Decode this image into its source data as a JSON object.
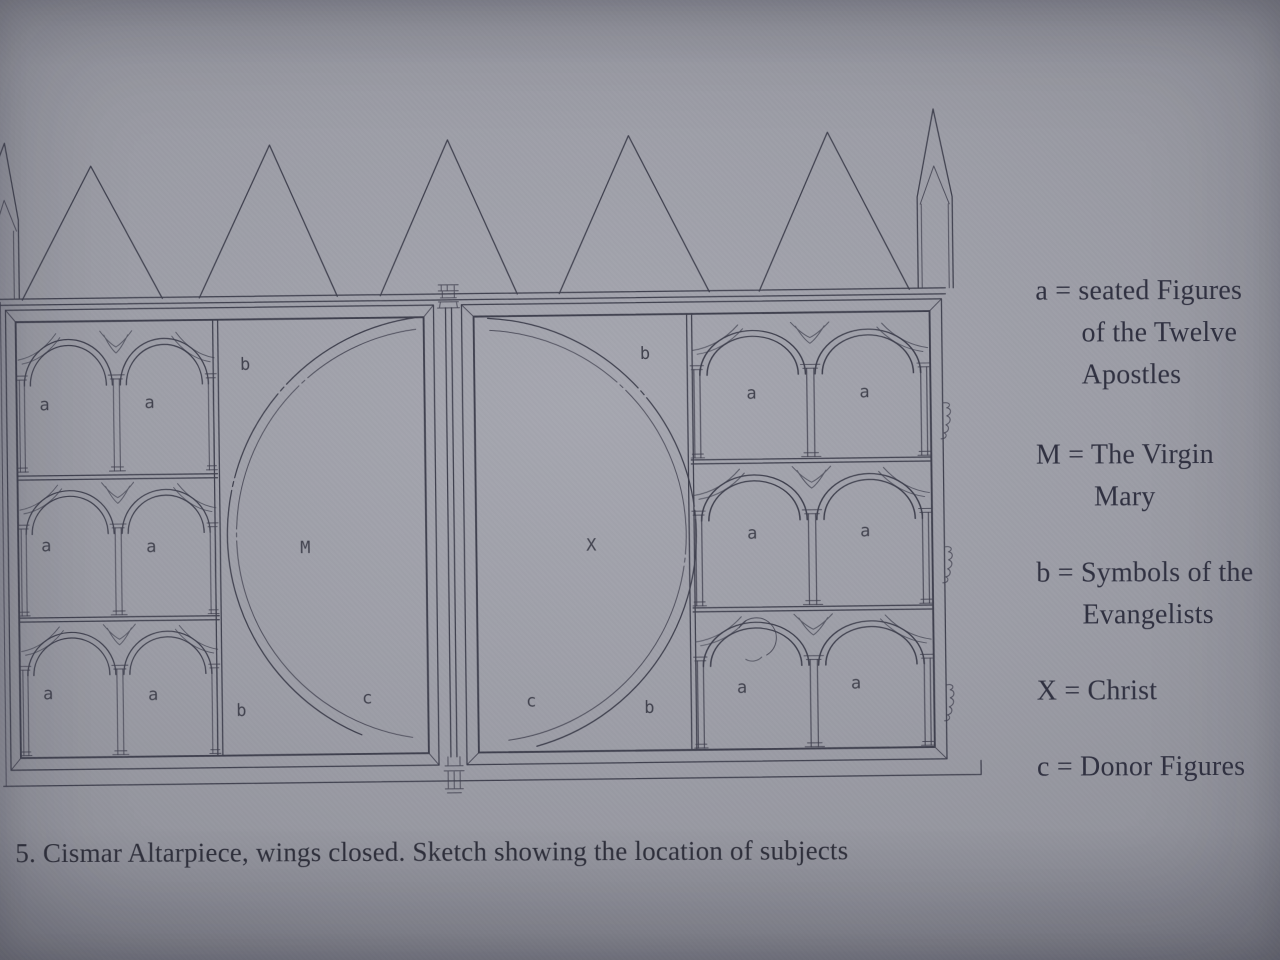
{
  "caption": "5. Cismar Altarpiece, wings closed. Sketch showing the location of subjects",
  "legend": {
    "entries": [
      {
        "symbol": "a",
        "meaning": "seated Figures of the Twelve Apostles",
        "lines": [
          "a = seated Figures",
          "of the Twelve",
          "Apostles"
        ]
      },
      {
        "symbol": "M",
        "meaning": "The Virgin Mary",
        "lines": [
          "M = The Virgin",
          "Mary"
        ]
      },
      {
        "symbol": "b",
        "meaning": "Symbols of the Evangelists",
        "lines": [
          "b = Symbols of the",
          "Evangelists"
        ]
      },
      {
        "symbol": "X",
        "meaning": "Christ",
        "lines": [
          "X = Christ"
        ]
      },
      {
        "symbol": "c",
        "meaning": "Donor Figures",
        "lines": [
          "c = Donor Figures"
        ]
      }
    ]
  },
  "diagram": {
    "subject": "Cismar Altarpiece sketch, wings closed",
    "labels": [
      {
        "char": "a",
        "location": "left-panel-row1-bay1"
      },
      {
        "char": "a",
        "location": "left-panel-row1-bay2"
      },
      {
        "char": "a",
        "location": "left-panel-row2-bay1"
      },
      {
        "char": "a",
        "location": "left-panel-row2-bay2"
      },
      {
        "char": "a",
        "location": "left-panel-row3-bay1"
      },
      {
        "char": "a",
        "location": "left-panel-row3-bay2"
      },
      {
        "char": "b",
        "location": "left-panel-top-of-arc"
      },
      {
        "char": "M",
        "location": "left-panel-arc-center"
      },
      {
        "char": "b",
        "location": "left-panel-bottom-of-arc"
      },
      {
        "char": "c",
        "location": "left-panel-bottom-right"
      },
      {
        "char": "b",
        "location": "right-panel-top-of-arc"
      },
      {
        "char": "X",
        "location": "right-panel-arc-center"
      },
      {
        "char": "c",
        "location": "right-panel-bottom-left"
      },
      {
        "char": "b",
        "location": "right-panel-bottom-of-arc"
      },
      {
        "char": "a",
        "location": "right-panel-row1-bay1"
      },
      {
        "char": "a",
        "location": "right-panel-row1-bay2"
      },
      {
        "char": "a",
        "location": "right-panel-row2-bay1"
      },
      {
        "char": "a",
        "location": "right-panel-row2-bay2"
      },
      {
        "char": "a",
        "location": "right-panel-row3-bay1"
      },
      {
        "char": "a",
        "location": "right-panel-row3-bay2"
      }
    ]
  },
  "colors": {
    "paper": "#9c9da6",
    "ink": "#3f404e",
    "text": "#2f3040"
  }
}
